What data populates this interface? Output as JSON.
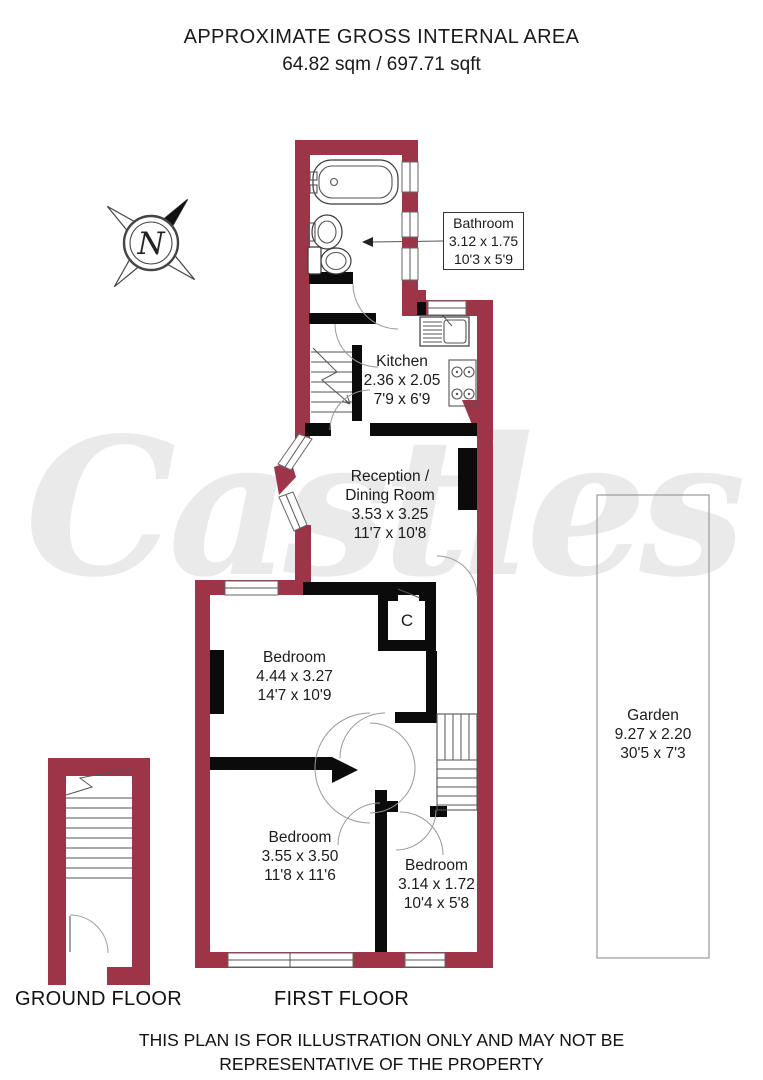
{
  "header": {
    "title": "APPROXIMATE GROSS INTERNAL AREA",
    "area": "64.82 sqm / 697.71 sqft"
  },
  "watermark": "Castles",
  "compass": {
    "north_label": "N"
  },
  "rooms": {
    "bathroom": {
      "name": "Bathroom",
      "metric": "3.12 x 1.75",
      "imperial": "10'3 x 5'9"
    },
    "kitchen": {
      "name": "Kitchen",
      "metric": "2.36 x 2.05",
      "imperial": "7'9 x 6'9"
    },
    "reception": {
      "name_line1": "Reception /",
      "name_line2": "Dining Room",
      "metric": "3.53 x 3.25",
      "imperial": "11'7 x 10'8"
    },
    "bedroom1": {
      "name": "Bedroom",
      "metric": "4.44 x 3.27",
      "imperial": "14'7 x 10'9"
    },
    "bedroom2": {
      "name": "Bedroom",
      "metric": "3.55 x 3.50",
      "imperial": "11'8 x 11'6"
    },
    "bedroom3": {
      "name": "Bedroom",
      "metric": "3.14 x 1.72",
      "imperial": "10'4 x 5'8"
    },
    "garden": {
      "name": "Garden",
      "metric": "9.27 x 2.20",
      "imperial": "30'5 x 7'3"
    },
    "closet": {
      "label": "C"
    }
  },
  "floor_labels": {
    "ground": "GROUND FLOOR",
    "first": "FIRST FLOOR"
  },
  "disclaimer": {
    "line1": "THIS PLAN IS FOR ILLUSTRATION ONLY AND MAY NOT BE",
    "line2": "REPRESENTATIVE OF THE PROPERTY"
  },
  "colors": {
    "wall": "#9e3448",
    "interior_wall": "#0b0b0b",
    "watermark": "#eaeaea"
  }
}
